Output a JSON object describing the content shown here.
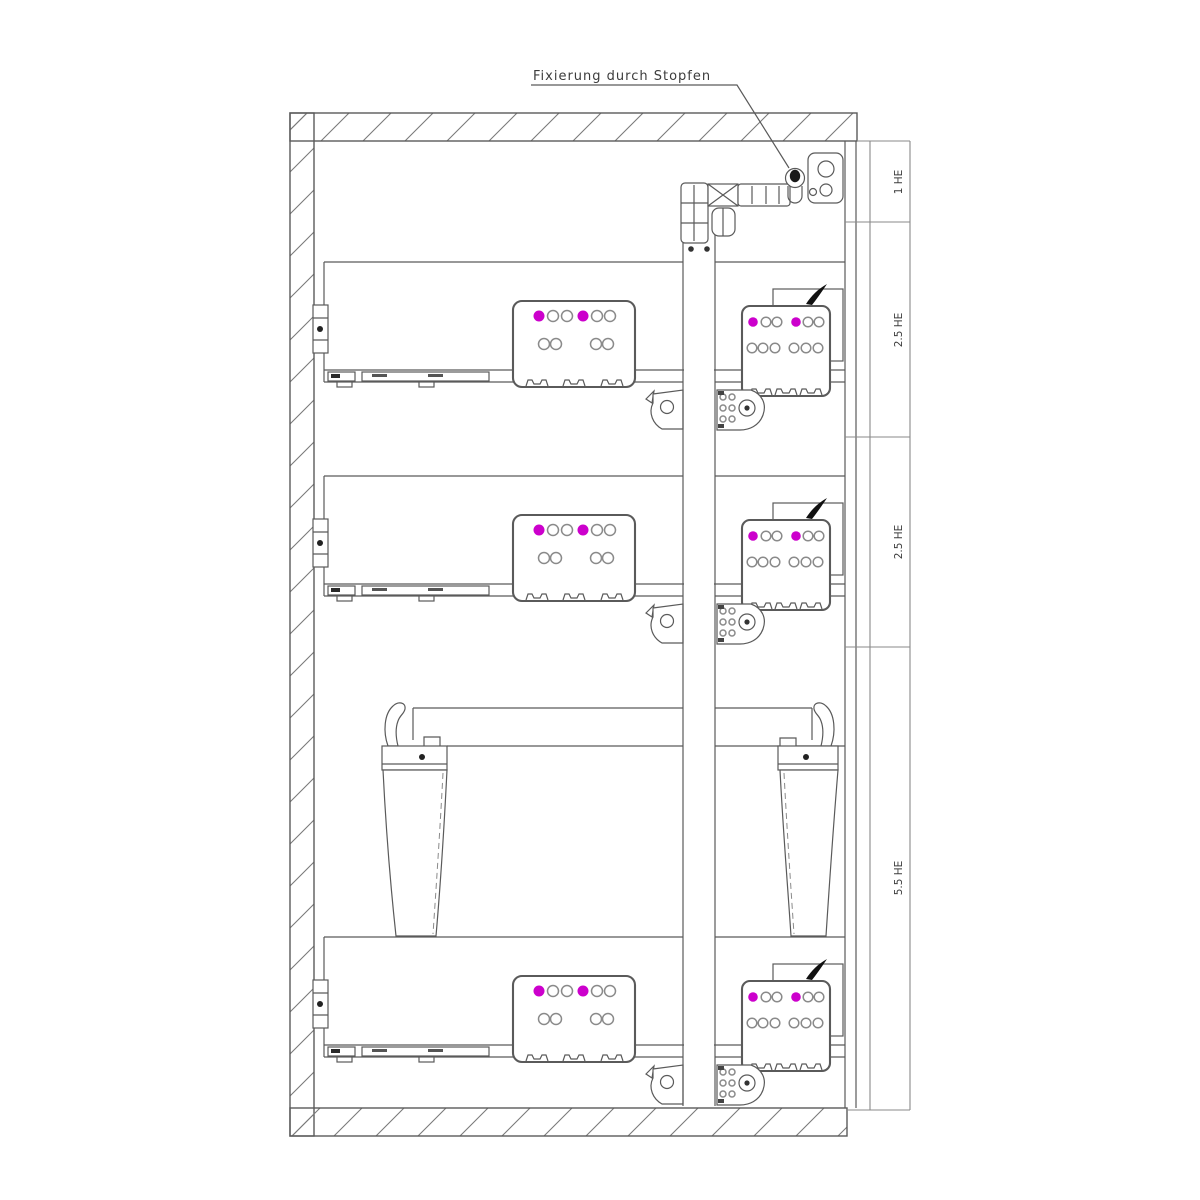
{
  "drawing_type": "cabinet-cross-section",
  "annotation": {
    "label": "Fixierung durch Stopfen"
  },
  "dimension_labels": [
    {
      "text": "1 HE"
    },
    {
      "text": "2.5 HE"
    },
    {
      "text": "2.5 HE"
    },
    {
      "text": "5.5 HE"
    }
  ],
  "icons": {
    "plug": "fixing-plug-icon",
    "connector_active": "magenta-connector-dot",
    "connector_inactive": "outline-connector-dot"
  },
  "colors": {
    "background": "#ffffff",
    "line": "#5a5a5a",
    "line_light": "#8a8a8a",
    "text": "#3c3c3c",
    "accent": "#cc00cc",
    "plug": "#1a1a1a"
  }
}
